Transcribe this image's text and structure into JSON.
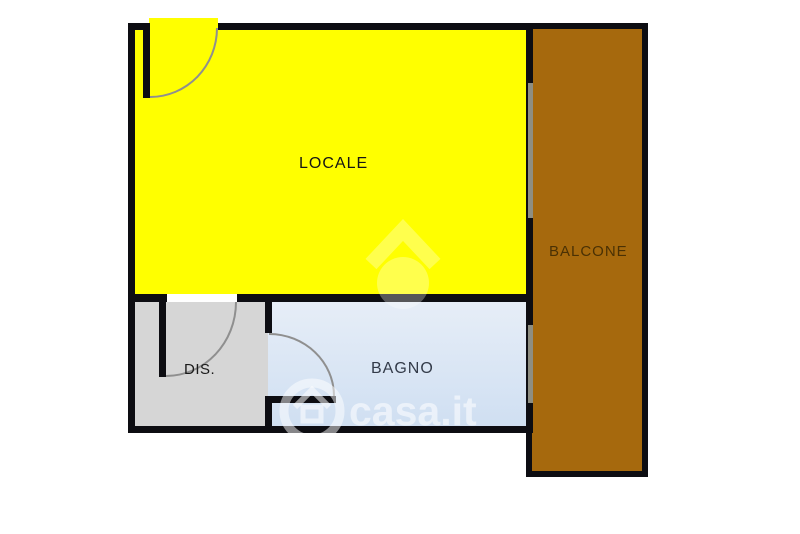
{
  "floorplan": {
    "rooms": {
      "locale": {
        "label": "LOCALE",
        "color": "#FFFF00"
      },
      "balcone": {
        "label": "BALCONE",
        "color": "#A6690D"
      },
      "dis": {
        "label": "DIS.",
        "color": "#D6D6D6"
      },
      "bagno": {
        "label": "BAGNO",
        "color": "#D9E4F3"
      }
    },
    "watermark": {
      "text": "casa.it",
      "logo": "house-icon"
    },
    "colors": {
      "background": "#FFFFFF",
      "wall": "#0D0D12",
      "door_arc": "#8F8F8F",
      "window_line": "#8E8E82",
      "watermark": "#FFFFFF"
    }
  }
}
